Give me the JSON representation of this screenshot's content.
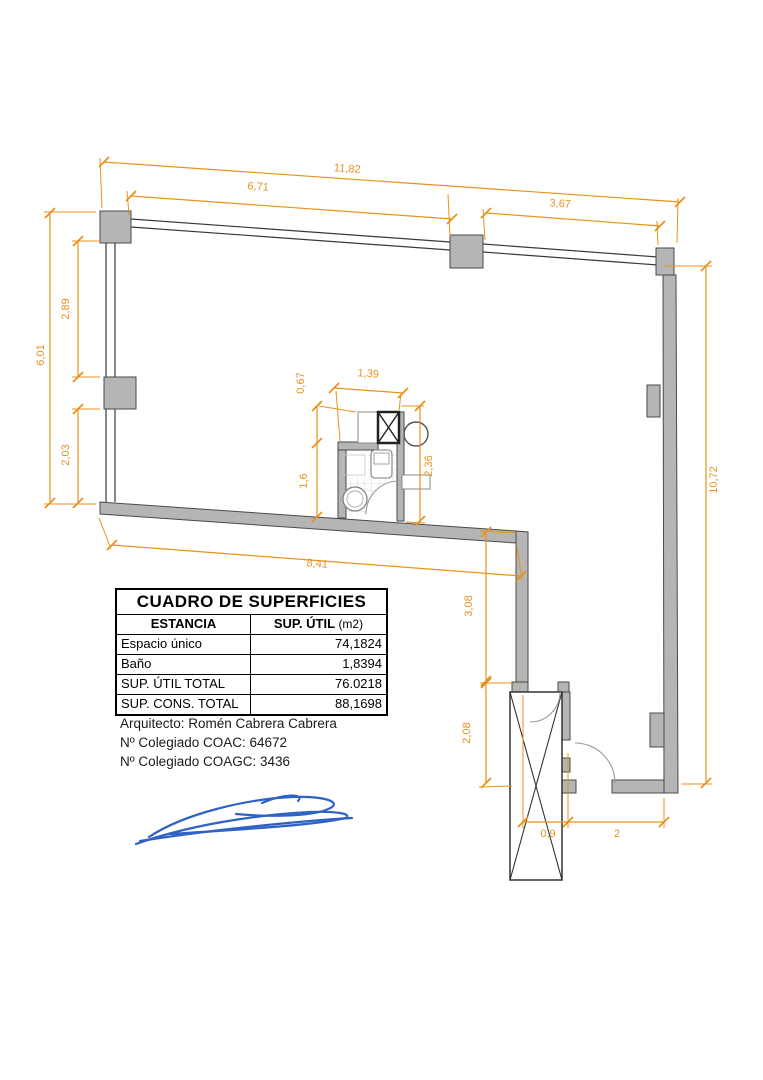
{
  "plan": {
    "dimensions": {
      "top_total": "11,82",
      "top_left": "6,71",
      "top_right": "3,67",
      "left_total": "6,01",
      "left_upper": "2,89",
      "left_lower": "2,03",
      "right_total": "10,72",
      "bath_shaft_depth": "0,67",
      "bath_width": "1,39",
      "bath_height": "1,6",
      "bath_total_height": "2,36",
      "bottom_width": "8,41",
      "step_height": "3,08",
      "entry_height": "2,08",
      "core_width": "0,9",
      "entry_width": "2"
    },
    "colors": {
      "dimension_accent": "#E8921C",
      "wall_fill": "#B5B5B5",
      "wall_stroke": "#4A4A4A",
      "signature_blue": "#2F62C5"
    }
  },
  "table": {
    "title": "CUADRO DE SUPERFICIES",
    "col1_header": "ESTANCIA",
    "col2_header_bold": "SUP. ÚTIL",
    "col2_header_unit": "(m2)",
    "rows": [
      {
        "label": "Espacio único",
        "value": "74,1824"
      },
      {
        "label": "Baño",
        "value": "1,8394"
      },
      {
        "label": "SUP. ÚTIL TOTAL",
        "value": "76.0218"
      },
      {
        "label": "SUP. CONS. TOTAL",
        "value": "88,1698"
      }
    ]
  },
  "architect": {
    "line1": "Arquitecto: Romén Cabrera Cabrera",
    "line2": "Nº Colegiado COAC: 64672",
    "line3": "Nº Colegiado COAGC: 3436"
  }
}
